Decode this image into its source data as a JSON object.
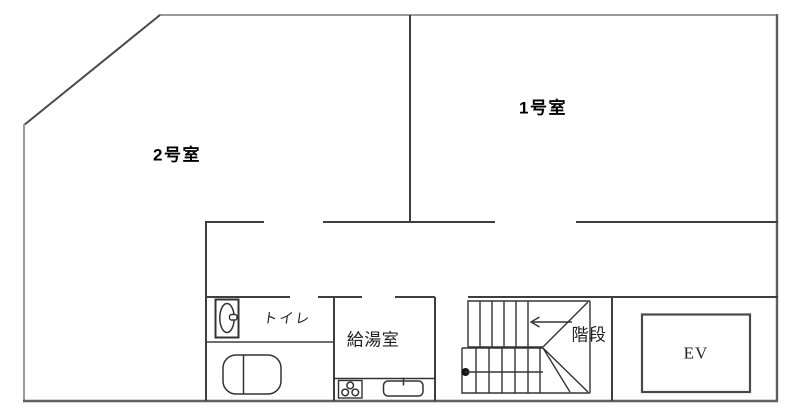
{
  "floorplan": {
    "units": [
      {
        "label": "1号室"
      },
      {
        "label": "2号室"
      }
    ],
    "facilities": [
      {
        "label": "トイレ"
      },
      {
        "label": "給湯室"
      },
      {
        "label": "階段"
      },
      {
        "label": "EV"
      }
    ],
    "colors": {
      "background": "#ffffff",
      "outer_wall": "#9a9a9a",
      "outer_wall_dark": "#5f5f5f",
      "diagonal_wall": "#4a4a4a",
      "inner_wall": "#3e3e3e",
      "fixture_line": "#333333",
      "elevator_wall": "#4a4a4a",
      "unit_text": "#000000",
      "facility_text": "#1f1f1f"
    }
  }
}
